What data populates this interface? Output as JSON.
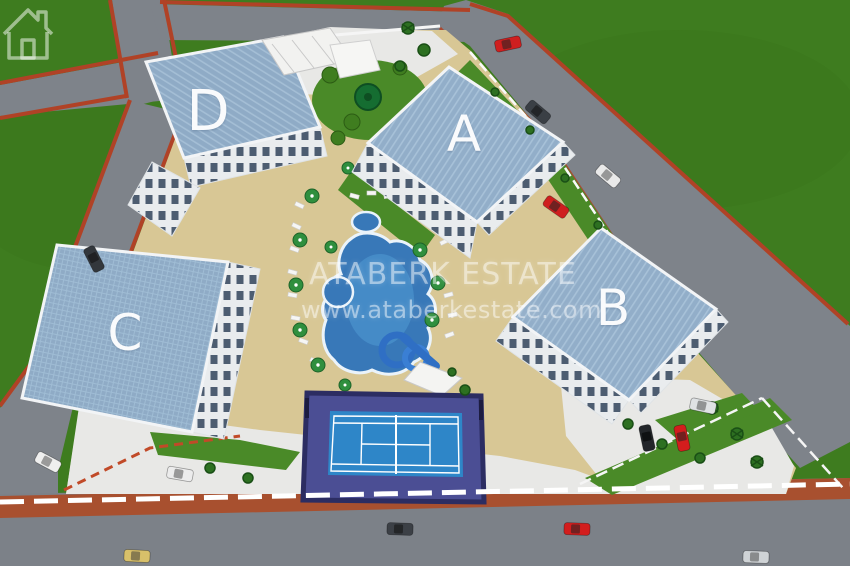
{
  "scene": {
    "type": "aerial-3d-render",
    "subject": "Residential complex site plan with four apartment blocks, pool and tennis court"
  },
  "buildings": [
    {
      "label": "A"
    },
    {
      "label": "B"
    },
    {
      "label": "C"
    },
    {
      "label": "D"
    }
  ],
  "watermark": {
    "brand": "ATABERK ESTATE",
    "url": "www.ataberkestate.com",
    "logo_icon": "house-outline-icon"
  },
  "amenities": [
    "swimming-pool",
    "kids-pool",
    "water-slide",
    "tennis-court",
    "gazebo",
    "sun-loungers",
    "pool-umbrellas",
    "parking-area",
    "palm-trees",
    "perimeter-fence"
  ],
  "cars": {
    "count": 14,
    "colors": [
      "red",
      "white",
      "silver",
      "black",
      "dark-gray",
      "beige"
    ]
  },
  "palette": {
    "grass": "#3e7c1f",
    "road": "#7e838a",
    "curb": "#b04226",
    "roof": "#92aec9",
    "pool_deck": "#d8c795",
    "pool_water": "#3878b8",
    "tennis_outer": "#4b4e94",
    "tennis_court": "#2e86c8",
    "pavement": "#e8e8e6",
    "garden": "#4a8a28"
  }
}
